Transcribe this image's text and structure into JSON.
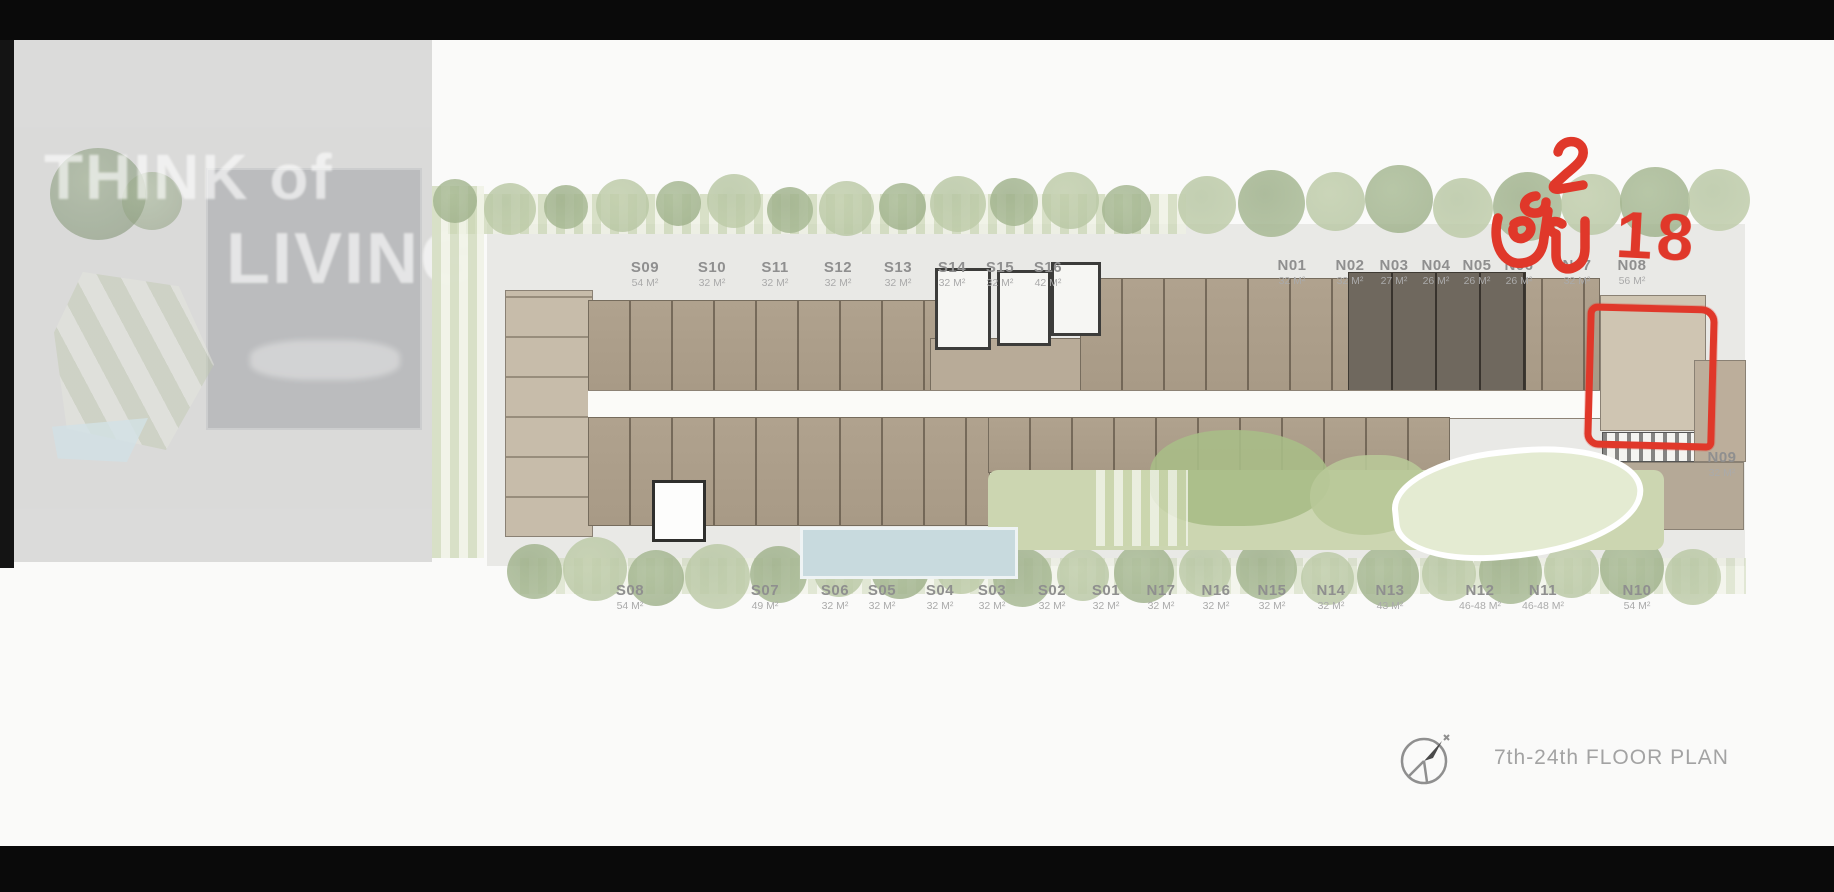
{
  "watermark": {
    "line1": "THINK of",
    "line2": "LIVING"
  },
  "annotation": {
    "text": "ชั้น 18",
    "thai_word": "ชั้น",
    "number": "18",
    "meaning": "Floor 18",
    "highlighted_unit": "N08",
    "color": "#e0382a"
  },
  "footer": {
    "title": "7th-24th FLOOR PLAN"
  },
  "units": {
    "top_south": [
      {
        "name": "S09",
        "area": "54 M²"
      },
      {
        "name": "S10",
        "area": "32 M²"
      },
      {
        "name": "S11",
        "area": "32 M²"
      },
      {
        "name": "S12",
        "area": "32 M²"
      },
      {
        "name": "S13",
        "area": "32 M²"
      },
      {
        "name": "S14",
        "area": "32 M²"
      },
      {
        "name": "S15",
        "area": "32 M²"
      },
      {
        "name": "S16",
        "area": "42 M²"
      }
    ],
    "top_north": [
      {
        "name": "N01",
        "area": "32 M²"
      },
      {
        "name": "N02",
        "area": "32 M²"
      },
      {
        "name": "N03",
        "area": "27 M²"
      },
      {
        "name": "N04",
        "area": "26 M²"
      },
      {
        "name": "N05",
        "area": "26 M²"
      },
      {
        "name": "N06",
        "area": "26 M²"
      },
      {
        "name": "N07",
        "area": "32 M²"
      },
      {
        "name": "N08",
        "area": "56 M²"
      }
    ],
    "right_side": [
      {
        "name": "N09",
        "area": "32 M²"
      }
    ],
    "bottom": [
      {
        "name": "S08",
        "area": "54 M²"
      },
      {
        "name": "S07",
        "area": "49 M²"
      },
      {
        "name": "S06",
        "area": "32 M²"
      },
      {
        "name": "S05",
        "area": "32 M²"
      },
      {
        "name": "S04",
        "area": "32 M²"
      },
      {
        "name": "S03",
        "area": "32 M²"
      },
      {
        "name": "S02",
        "area": "32 M²"
      },
      {
        "name": "S01",
        "area": "32 M²"
      },
      {
        "name": "N17",
        "area": "32 M²"
      },
      {
        "name": "N16",
        "area": "32 M²"
      },
      {
        "name": "N15",
        "area": "32 M²"
      },
      {
        "name": "N14",
        "area": "32 M²"
      },
      {
        "name": "N13",
        "area": "43 M²"
      },
      {
        "name": "N12",
        "area": "46-48 M²"
      },
      {
        "name": "N11",
        "area": "46-48 M²"
      },
      {
        "name": "N10",
        "area": "54 M²"
      }
    ]
  },
  "colors": {
    "annotation_red": "#e0382a",
    "unit_tan": "#b0a28e",
    "unit_dark": "#6f685e",
    "greenery": "#afbf9a",
    "pool_blue": "#c8dade",
    "label_gray": "#8f8f8f"
  }
}
